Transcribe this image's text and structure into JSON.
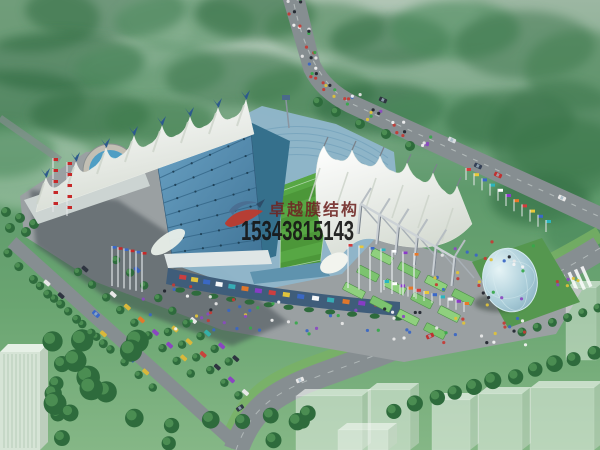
{
  "image": {
    "type": "architectural-rendering-aerial-view",
    "subject": "Aerial rendering of a stadium with white tensile membrane roofs, blue grandstand roof, green pitch, plazas, fountain, parking, roads and a glass dome",
    "watermark": {
      "company": "卓越膜结构",
      "phone": "15343815143",
      "logo_icon": "red-swoosh-logo"
    },
    "palette": {
      "watermark_red": "#6e2422",
      "phone_black": "#161616",
      "logo_red": "#c0392b",
      "logo_blue": "#4a6e92",
      "logo_dark": "#2c4a66",
      "membrane_white": "#f2f4ee",
      "membrane_shade": "#cdd4ca",
      "roof_blue": "#4e84ad",
      "roof_blue_dark": "#35708c",
      "roof_rib": "#2c5d7e",
      "bowl_blue": "#8fb6ca",
      "seat_line": "#6d9cb8",
      "pitch_green": "#4c9739",
      "pitch_green_light": "#57a744",
      "terrace_green": "#7cc36f",
      "terrace_green_alt": "#8fd07e",
      "plaza_grey": "#9aa0a2",
      "shadow_grey": "#3e464e",
      "road_grey": "#868e91",
      "lawn_green": "#79b264",
      "tree_dark": "#2e6b3c",
      "tree_mid": "#4f9154",
      "facade_blue": "#3f5d7a",
      "water_blue": "#4f9ec4",
      "egg_glass": "#a9ccd8",
      "steel_light": "#c9cfd4",
      "steel_dark": "#7a838c",
      "building_pale": "#d6e4d6",
      "ghost_white": "#eef4ee",
      "flag_red": "#c62828"
    }
  }
}
